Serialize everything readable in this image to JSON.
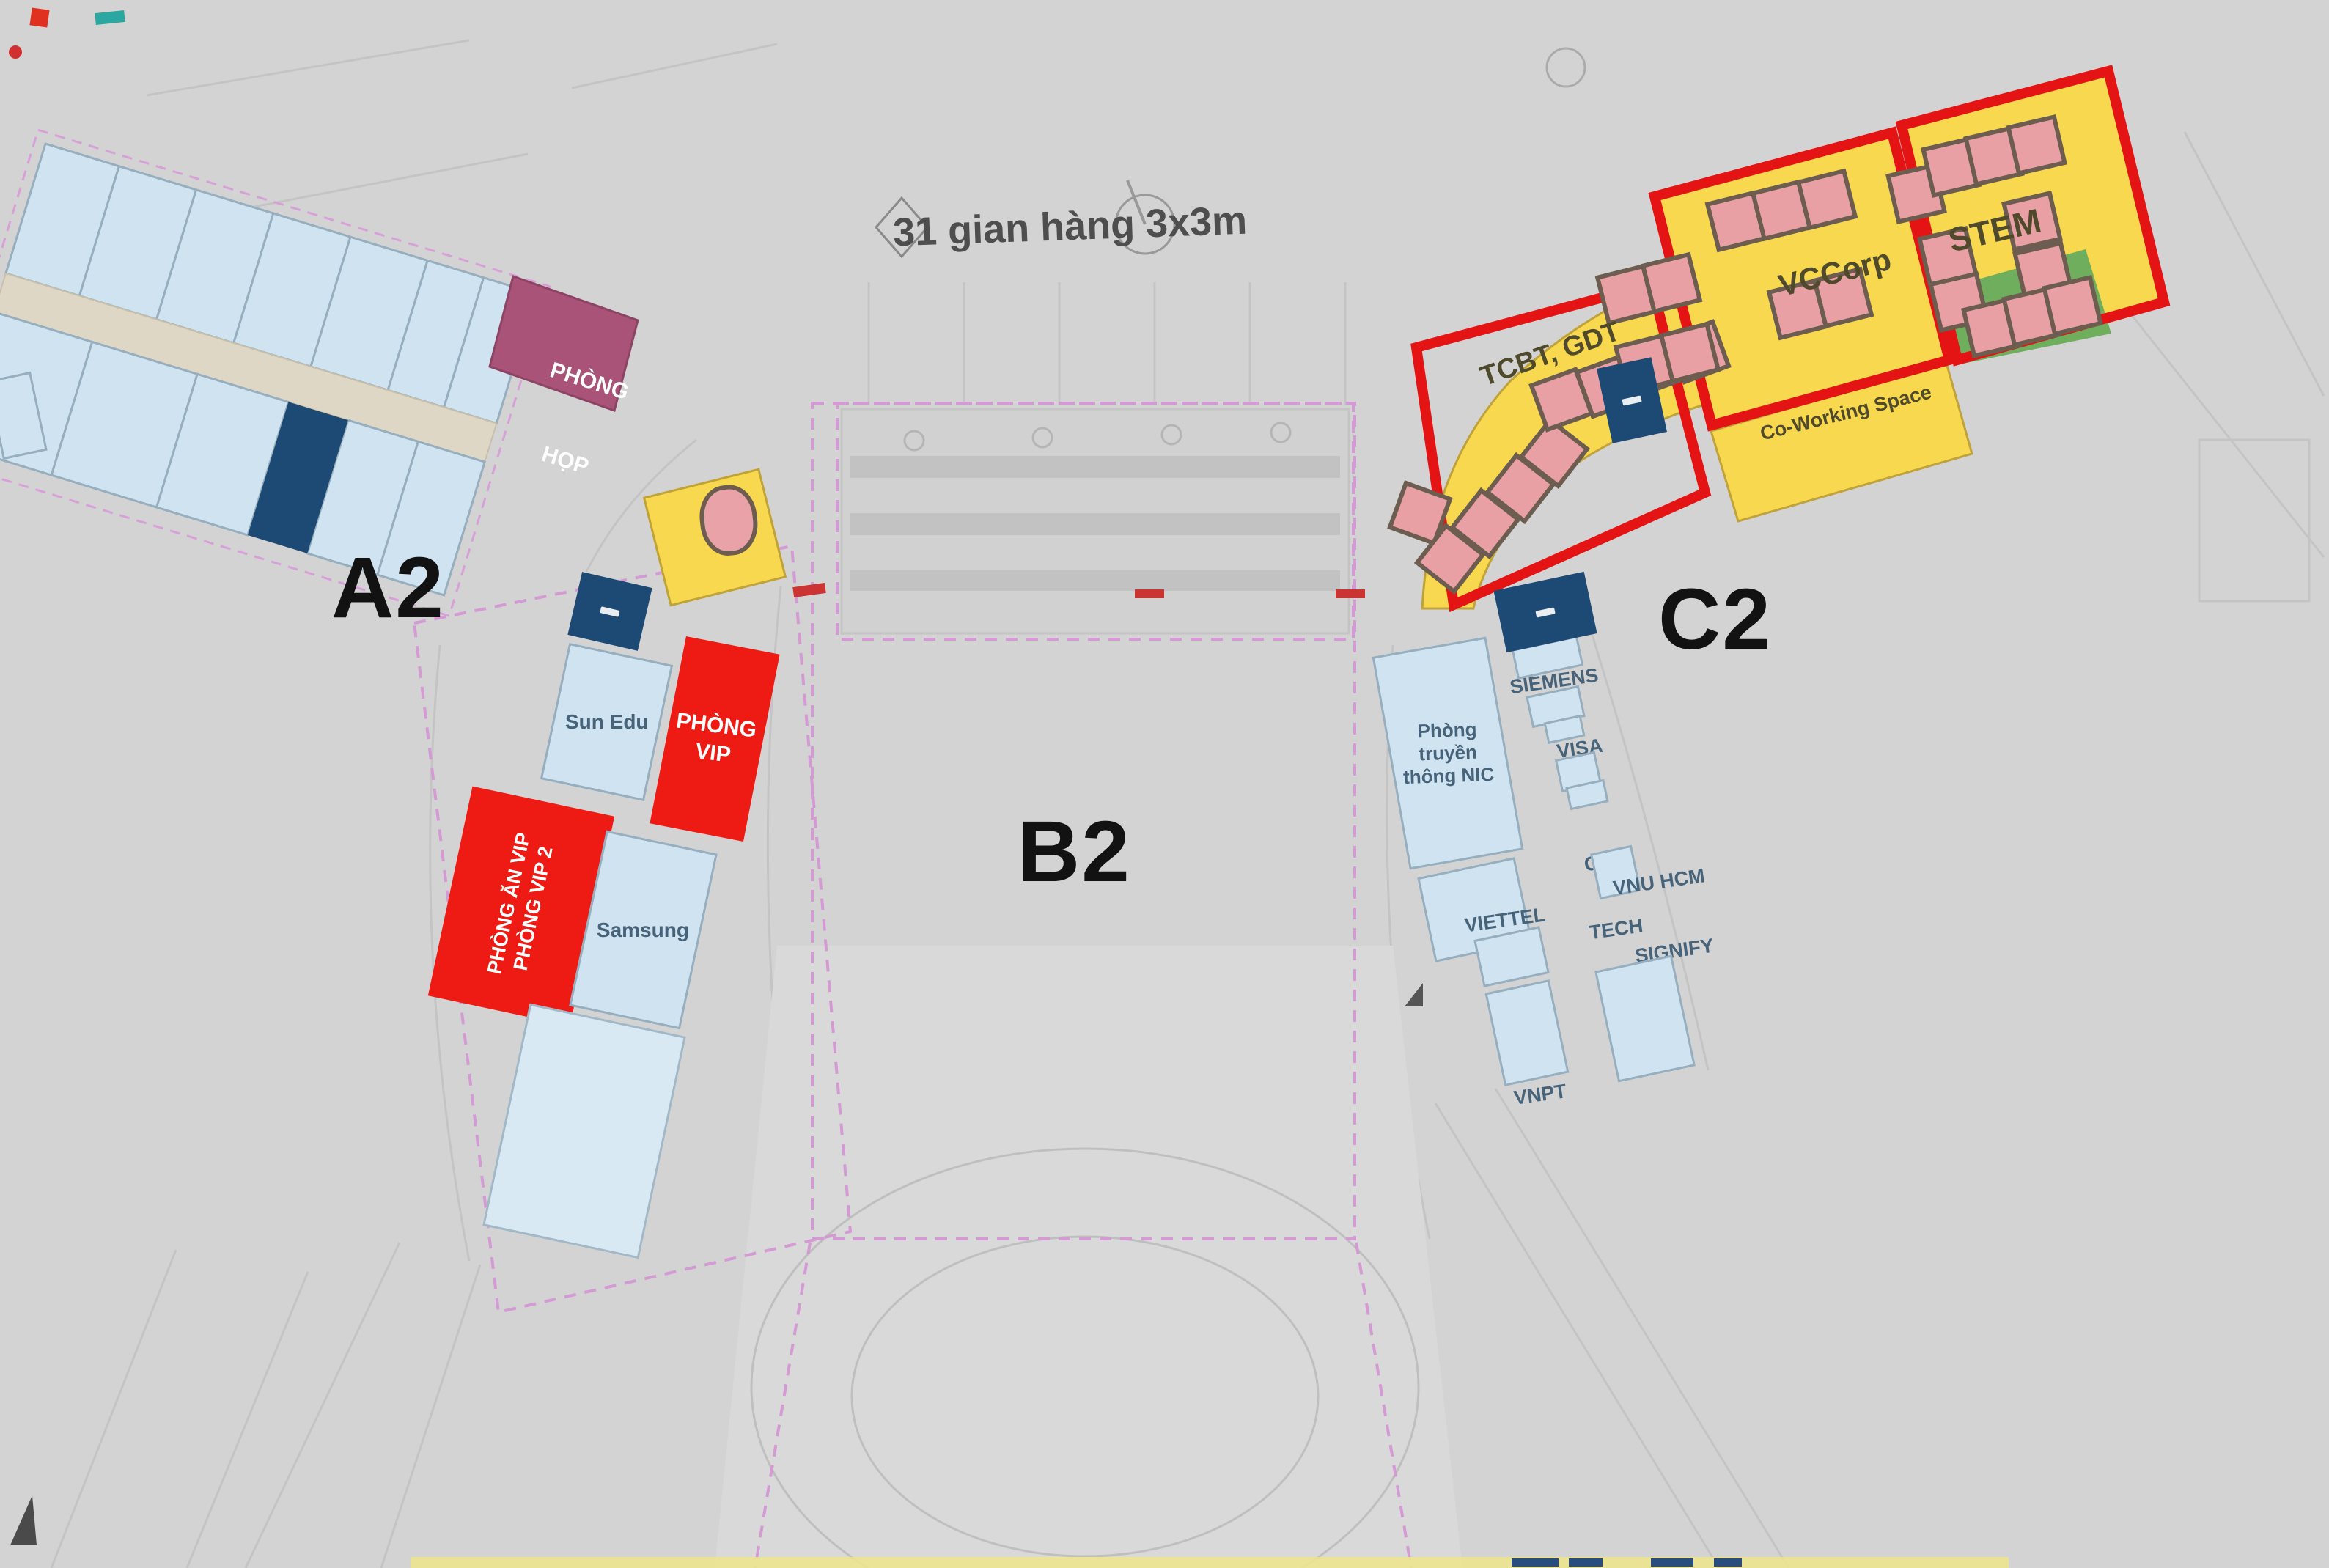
{
  "plan": {
    "note_booths": "31 gian hàng 3x3m",
    "wings": {
      "left": "A2",
      "center": "B2",
      "right": "C2"
    },
    "rooms": {
      "phong_hop": [
        "PHÒNG",
        "HỌP"
      ],
      "phong_vip": [
        "PHÒNG",
        "VIP"
      ],
      "phong_an_vip": [
        "PHÒNG ĂN VIP",
        "PHÒNG VIP 2"
      ],
      "sun_edu": "Sun Edu",
      "samsung": "Samsung"
    },
    "zones_right": {
      "tcbt": "TCBT, GDT",
      "vccorp": "VCCorp",
      "stem": "STEM",
      "coworking": "Co-Working Space"
    },
    "tenants_right": {
      "nic_media": [
        "Phòng",
        "truyền",
        "thông NIC"
      ],
      "siemens": "SIEMENS",
      "visa": "VISA",
      "cmc": [
        "CMC",
        "TECH"
      ],
      "vnu": "VNU HCM",
      "signify": "SIGNIFY",
      "viettel": "VIETTEL",
      "vnpt": "VNPT"
    },
    "colors": {
      "red": "#ee1b15",
      "yellow": "#f8d84e",
      "navy": "#1d4a74",
      "light_blue": "#cfe3f0",
      "purple": "#a85377",
      "green": "#6fae5c",
      "booth_pink": "#e9a0a4",
      "zone_outline_red": "#e41414",
      "dashed_boundary": "#d49ad4"
    }
  }
}
